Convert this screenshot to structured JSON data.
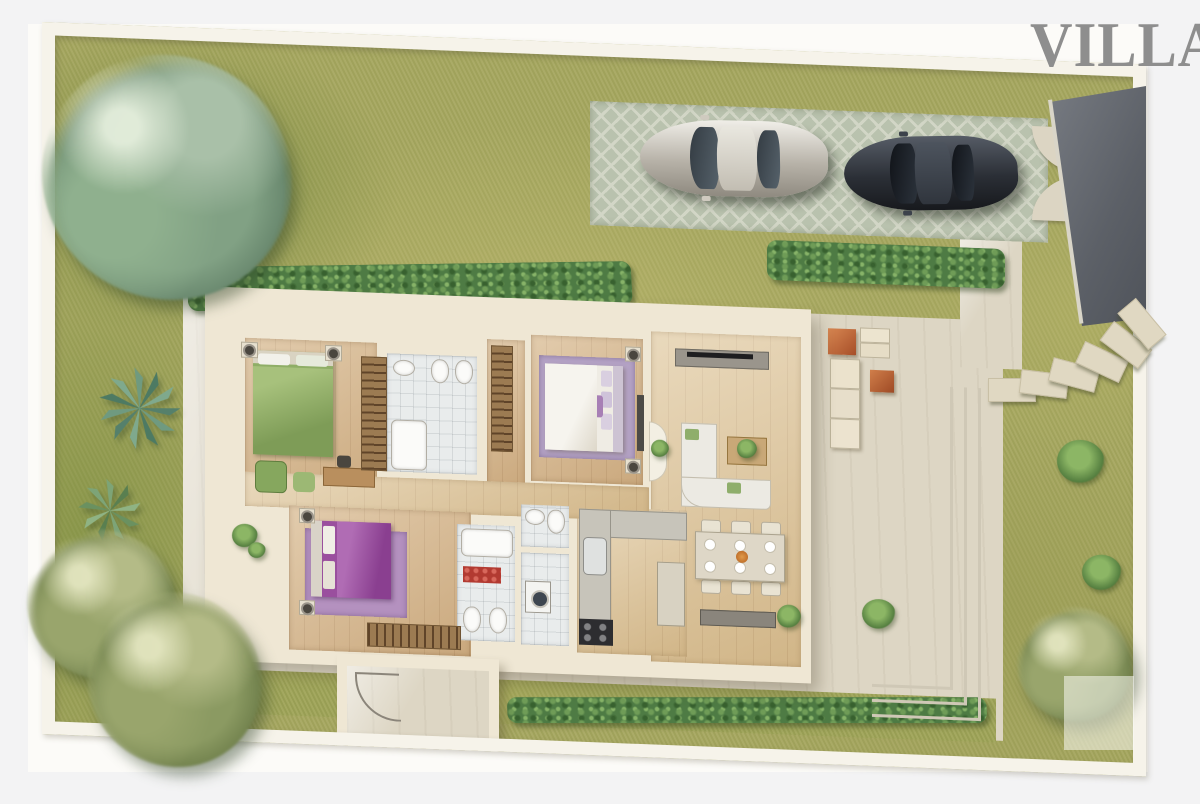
{
  "title": {
    "text": "VILLA 1"
  },
  "palette": {
    "page_margin": "#f3f3f4",
    "plan_paper": "#fcfbf8",
    "title_gray": "#8e8e8e",
    "boundary_wall": "#f6f3ea",
    "grass": "#a6a75f",
    "hedge_green": "#4e7b44",
    "concrete": "#ddd6c4",
    "driveway_lattice": "#b9c2ae",
    "road_asphalt": "#5c6067",
    "house_wall": "#efe7d4",
    "wood_floor": "#d6b68a",
    "bath_tile": "#e9ecec",
    "bed_green": "#8fae66",
    "bed_purple": "#9a4f9e",
    "rug_purple": "#b5a3c6",
    "rug_red": "#b23a31",
    "sofa_white": "#eceae3",
    "ottoman_orange": "#c06236",
    "car_silver": "#c7c2b8",
    "car_dark": "#2b2f36"
  },
  "scene": {
    "site": "walled villa lot with lawn, top-down render",
    "vehicles": [
      "silver-sedan",
      "dark-sedan"
    ],
    "driveway": "grass-paver lattice parking strip with street gate",
    "rooms": [
      "bedroom-green",
      "bathroom-main",
      "walk-in-closet",
      "master-bedroom",
      "living-room",
      "dining-area",
      "kitchen",
      "bedroom-purple",
      "bathroom-second",
      "wc",
      "laundry",
      "hallway",
      "entry-vestibule"
    ],
    "furniture": [
      "green-double-bed",
      "white-double-bed",
      "purple-double-bed",
      "l-shaped-sofa",
      "tv-sideboard",
      "coffee-table-plant",
      "dining-table-6-seats",
      "kitchen-counter",
      "stove",
      "sink",
      "bathtub",
      "toilet",
      "bidet",
      "washing-machine",
      "wardrobes"
    ],
    "garden": [
      "large-tree-top-left",
      "trees-bottom-left",
      "tree-bottom-right",
      "agave-plants-left",
      "hedge-top",
      "hedge-driveway",
      "hedge-bottom",
      "stepping-stones-path",
      "patio-steps",
      "outdoor-ottomans"
    ]
  }
}
